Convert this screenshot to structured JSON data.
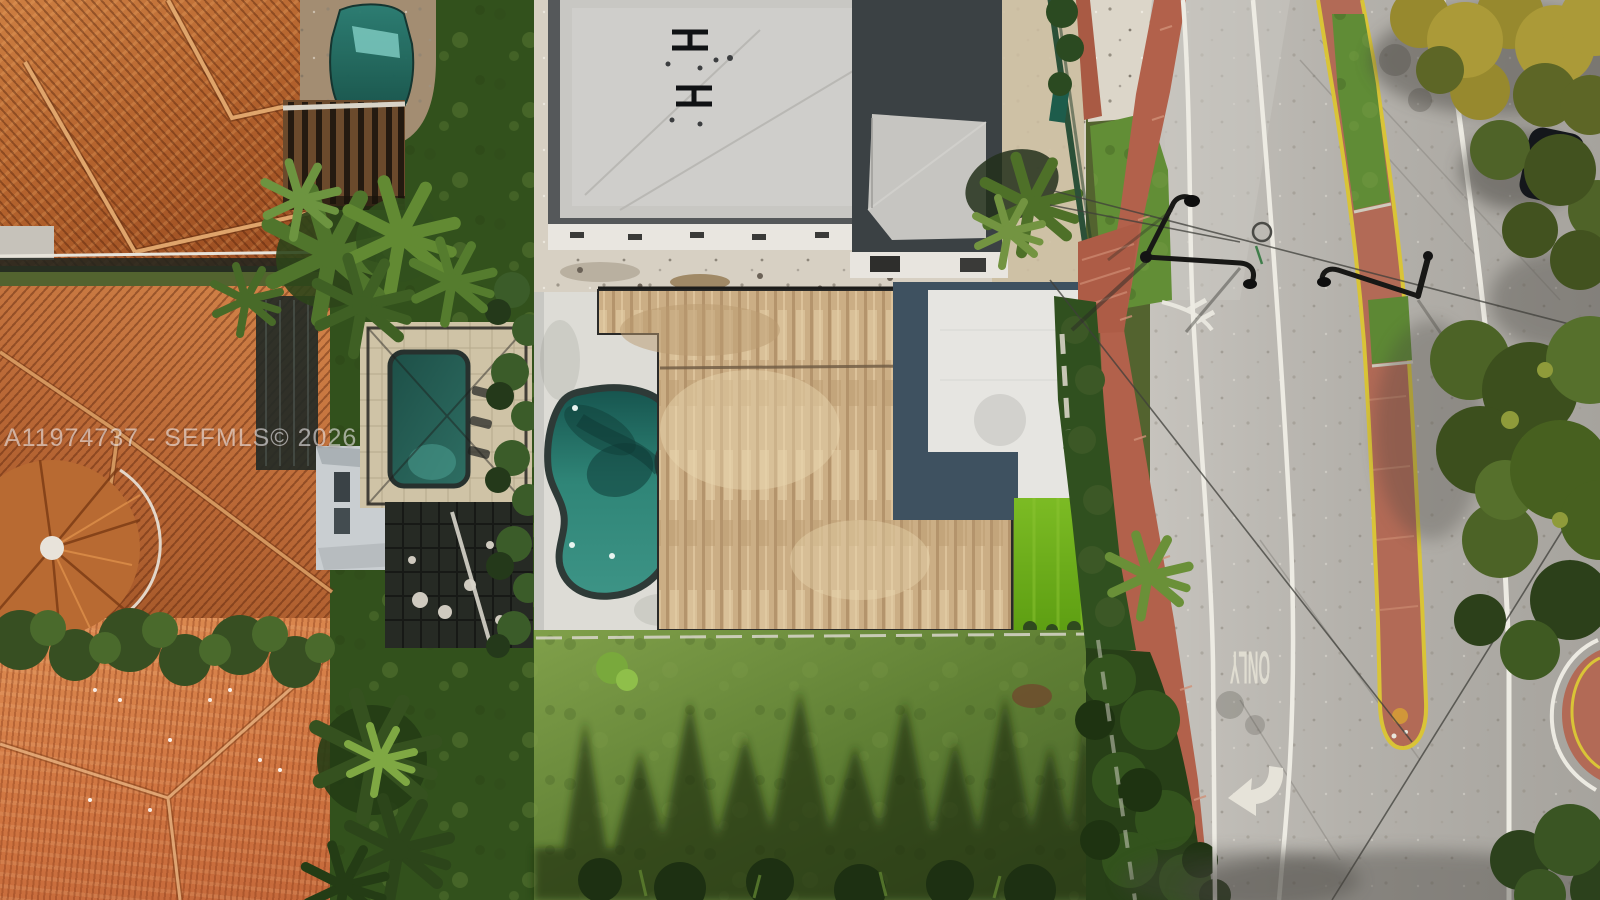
{
  "scene": {
    "description": "Aerial drone photo of residential lots: terracotta tile-roof homes with pools on the left, a concrete building under construction and a flat-roof house with kidney-shaped pool and artificial turf in the center, a shadow-streaked lawn below, and a divided road with red bike path, landscaped red median, street lights, ONLY lane marking and a left-turn arrow on the right.",
    "objects": [
      "terracotta-roof-house",
      "tile-roof-house",
      "turret-roof",
      "bay-window",
      "swimming-pool",
      "screened-pool-enclosure",
      "kidney-pool",
      "construction-building",
      "wood-sheathed-roof",
      "white-flat-roof",
      "artificial-turf",
      "lawn-with-tree-shadows",
      "palm-trees",
      "hedge",
      "divided-road",
      "red-bike-path",
      "red-brick-crosswalk",
      "landscaped-median",
      "street-lights",
      "power-lines",
      "only-lane-marking",
      "left-turn-arrow-marking",
      "lane-lines",
      "parked-car",
      "overhanging-trees"
    ]
  },
  "watermark": {
    "text": "A11974737 - SEFMLS© 2026"
  },
  "road_markings": {
    "lane_word": "ONLY"
  },
  "palette": {
    "terracotta_roof": "#b5642e",
    "coral_roof": "#cf7440",
    "pool_teal": "#2f857a",
    "pool_dark_teal": "#255f58",
    "concrete_gray": "#c8c7c3",
    "wood_roof_beige": "#ccb089",
    "white_roof": "#e6e5e1",
    "roof_border_navy": "#3e5160",
    "turf_green": "#6ab520",
    "lawn_green": "#5f7f34",
    "tree_green": "#4c5f28",
    "road_gray": "#b4b1ab",
    "bike_path_red": "#b2614b",
    "median_red": "#b26a56",
    "median_yellow": "#d9c437",
    "lane_line_white": "#edebe3"
  }
}
